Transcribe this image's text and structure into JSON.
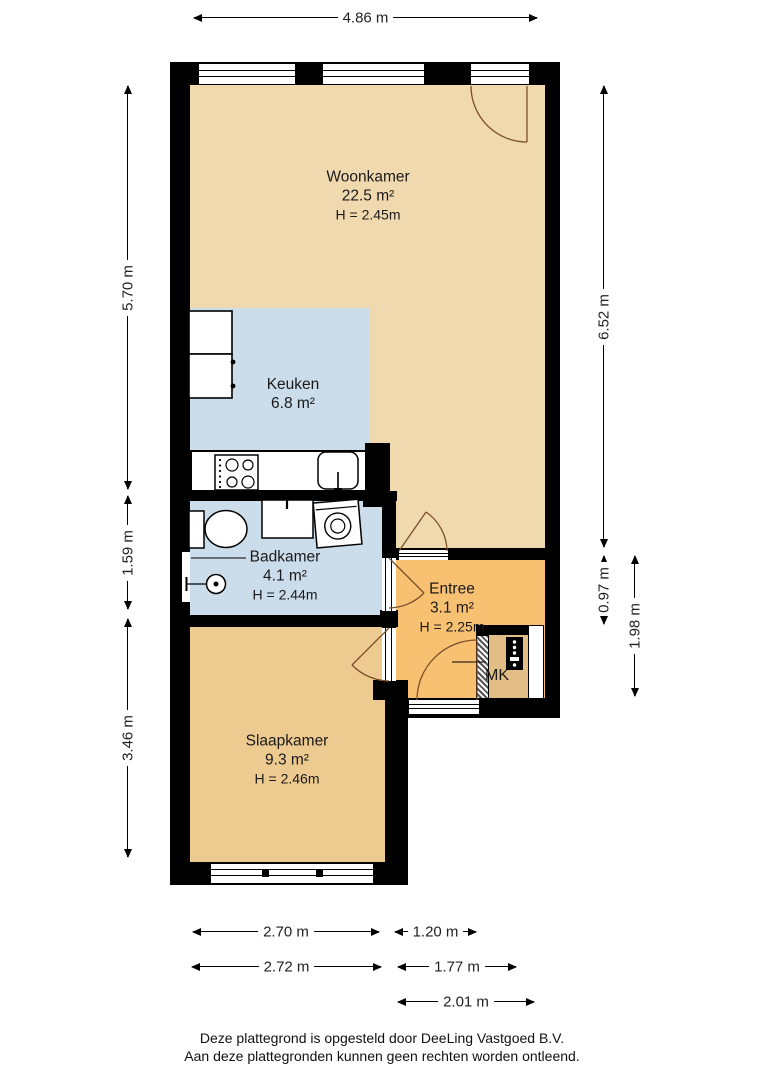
{
  "plan": {
    "rooms": {
      "woonkamer": {
        "name": "Woonkamer",
        "area": "22.5 m²",
        "ceiling": "H = 2.45m"
      },
      "keuken": {
        "name": "Keuken",
        "area": "6.8 m²"
      },
      "badkamer": {
        "name": "Badkamer",
        "area": "4.1 m²",
        "ceiling": "H = 2.44m"
      },
      "entree": {
        "name": "Entree",
        "area": "3.1 m²",
        "ceiling": "H = 2.25m"
      },
      "slaapkamer": {
        "name": "Slaapkamer",
        "area": "9.3 m²",
        "ceiling": "H = 2.46m"
      },
      "meterkast": {
        "name": "MK"
      }
    },
    "dimensions": {
      "top": "4.86 m",
      "left_total": "5.70 m",
      "left_badkamer": "1.59 m",
      "left_slaapkamer": "3.46 m",
      "right_total": "6.52 m",
      "right_entree_upper": "0.97 m",
      "right_entree_total": "1.98 m",
      "bottom_slaapkamer_inner": "2.70 m",
      "bottom_entree_inner": "1.20 m",
      "bottom_slaapkamer_outer": "2.72 m",
      "bottom_entree_mid": "1.77 m",
      "bottom_entree_outer": "2.01 m"
    },
    "colors": {
      "woonkamer": "#F1D9AF",
      "keuken": "#CBDCEA",
      "badkamer": "#CBDCEA",
      "entree": "#F8C171",
      "slaapkamer": "#EDCA90",
      "meterkast_floor": "#E2BD85",
      "wall": "#000000",
      "door_arc": "#7B4F28"
    }
  },
  "footer": {
    "line1": "Deze plattegrond is opgesteld door DeeLing Vastgoed B.V.",
    "line2": "Aan deze plattegronden kunnen geen rechten worden ontleend."
  }
}
